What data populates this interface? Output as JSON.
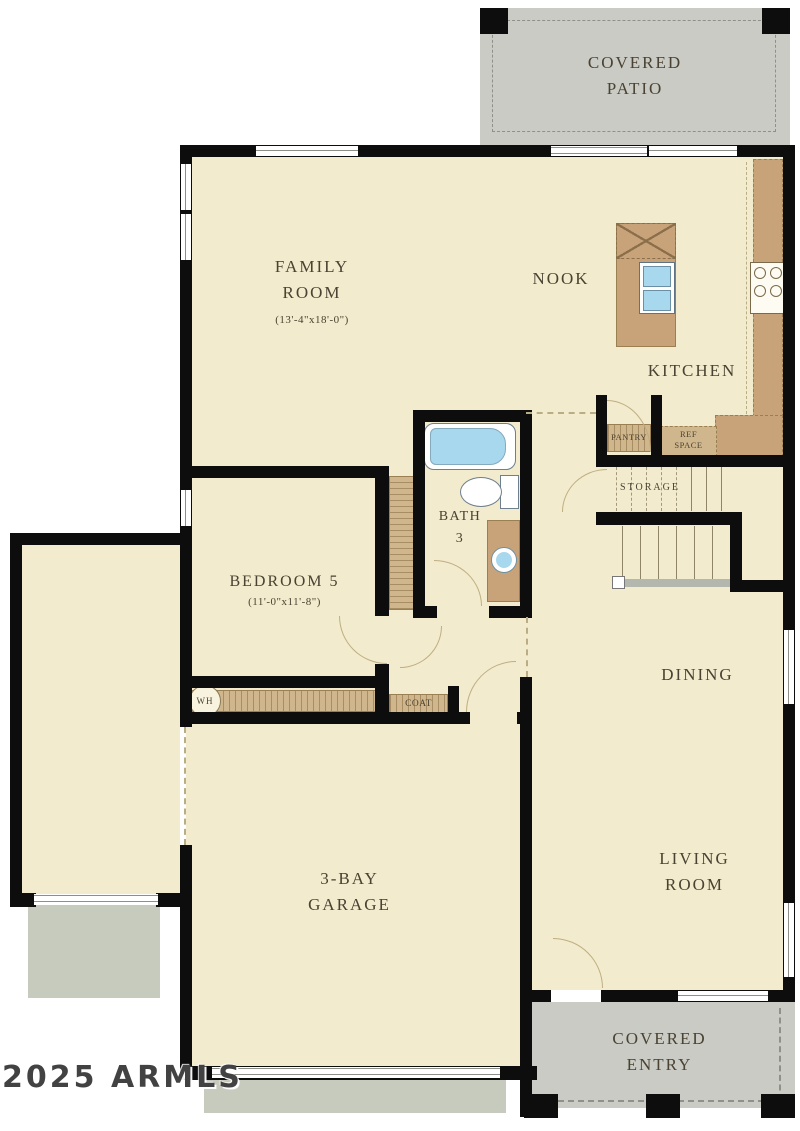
{
  "floorplan": {
    "watermark": "2025 ARMLS",
    "rooms": {
      "covered_patio": {
        "label": "COVERED\nPATIO"
      },
      "family_room": {
        "label": "FAMILY\nROOM",
        "dims": "(13'-4\"x18'-0\")"
      },
      "nook": {
        "label": "NOOK"
      },
      "kitchen": {
        "label": "KITCHEN"
      },
      "pantry": {
        "label": "PANTRY"
      },
      "ref_space": {
        "label": "REF\nSPACE"
      },
      "storage": {
        "label": "STORAGE"
      },
      "bath_3": {
        "label": "BATH\n3"
      },
      "bedroom_5": {
        "label": "BEDROOM 5",
        "dims": "(11'-0\"x11'-8\")"
      },
      "coat": {
        "label": "COAT"
      },
      "water_heater": {
        "label": "WH"
      },
      "dining": {
        "label": "DINING"
      },
      "garage": {
        "label": "3-BAY\nGARAGE"
      },
      "living_room": {
        "label": "LIVING\nROOM"
      },
      "covered_entry": {
        "label": "COVERED\nENTRY"
      }
    },
    "colors": {
      "floor": "#f2ebcd",
      "wall": "#0d0d0d",
      "patio": "#c9cbc4",
      "cabinet": "#c8a379",
      "shelf": "#cfb68d",
      "water": "#a8d8ee",
      "driveway": "#c7cbbd",
      "label": "#4a4232"
    }
  }
}
